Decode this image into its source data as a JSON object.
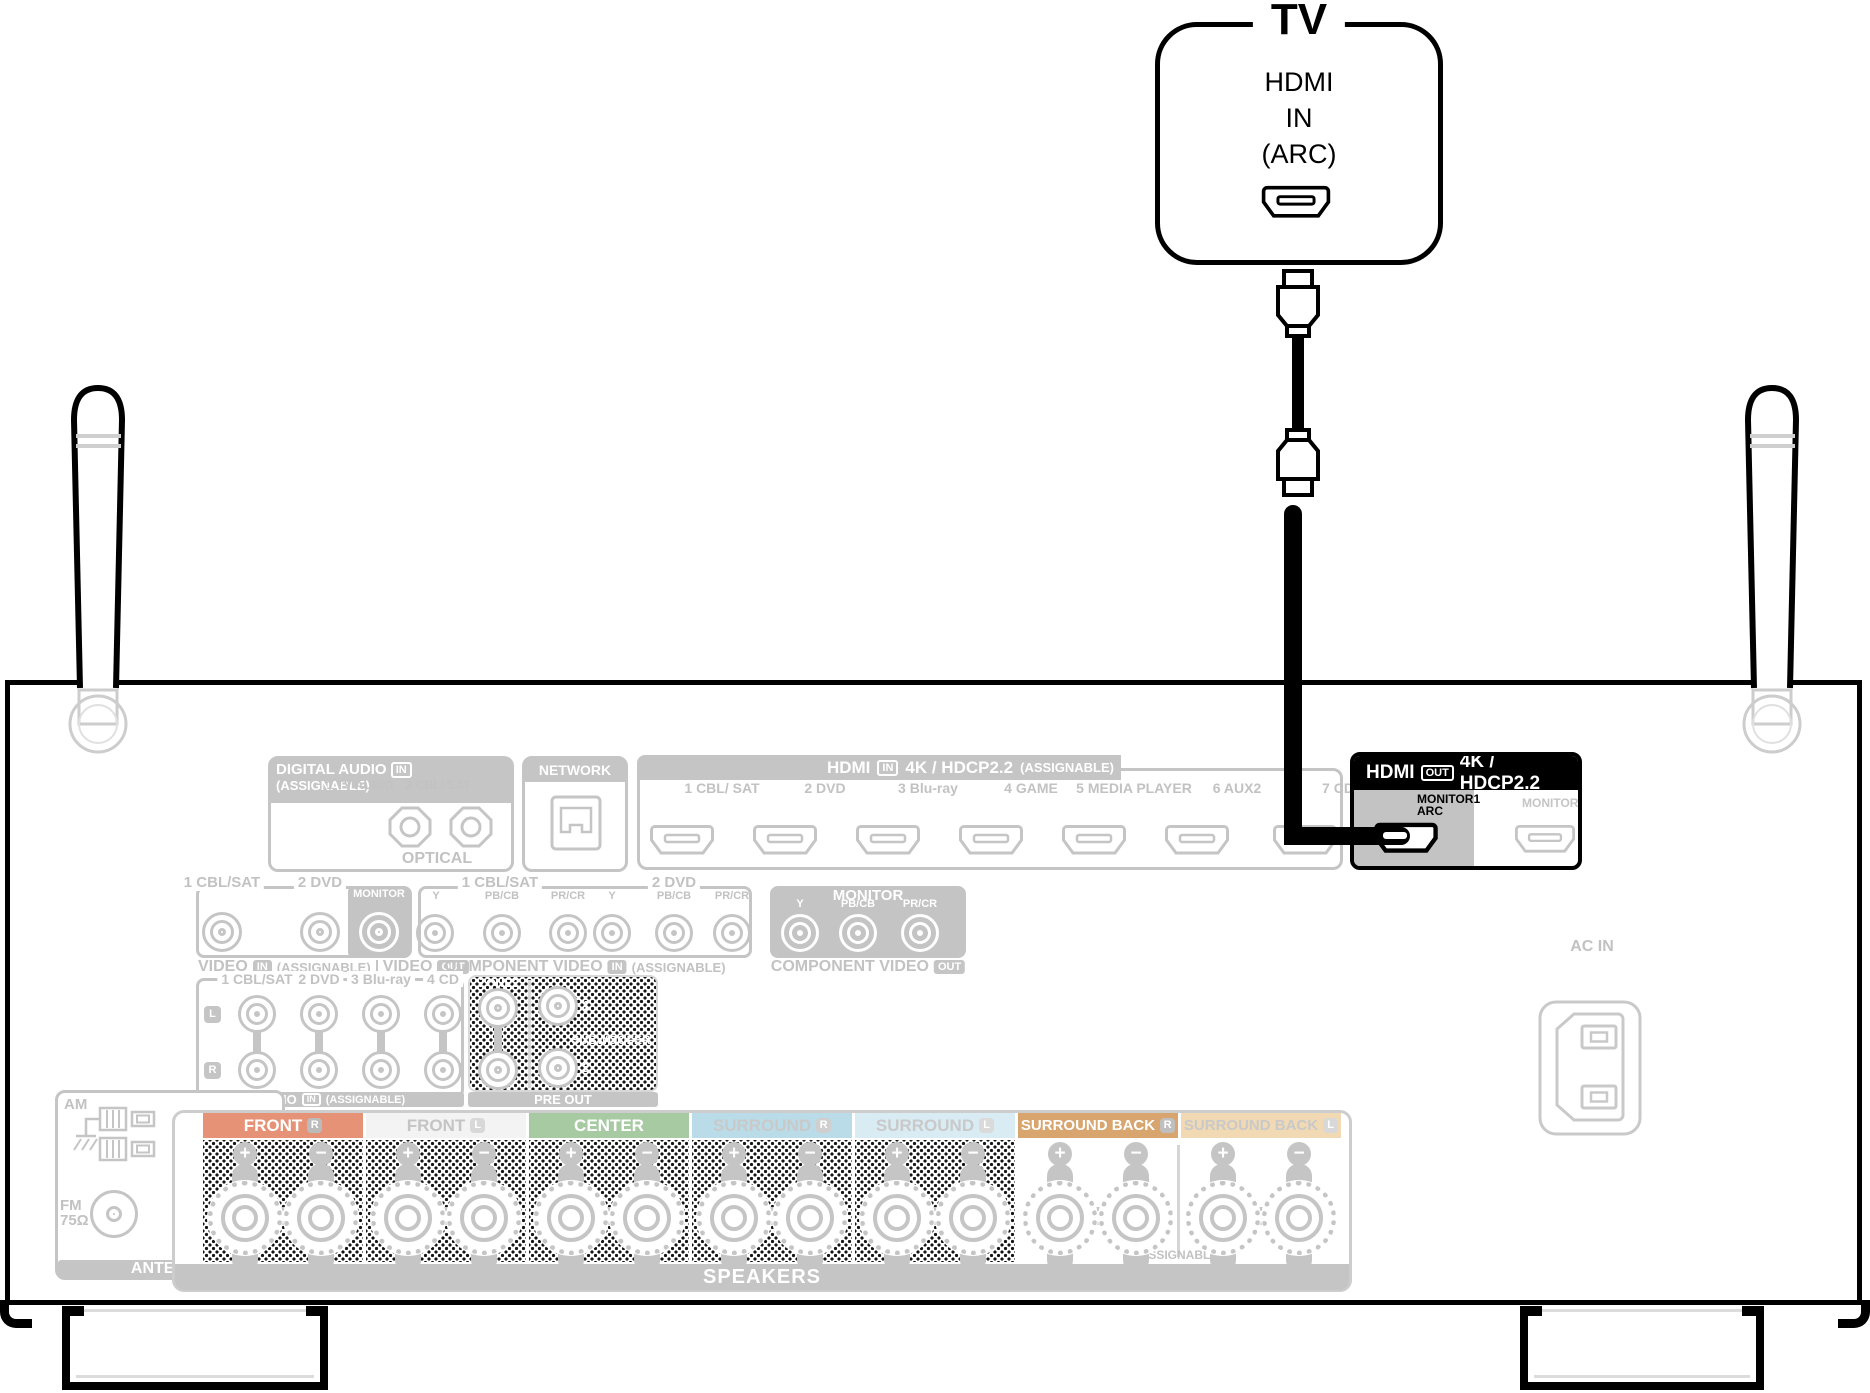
{
  "tv": {
    "label": "TV",
    "port_lines": "HDMI\nIN\n(ARC)"
  },
  "receiver": {
    "digital_audio": {
      "title": "DIGITAL AUDIO",
      "badge": "IN",
      "note": "(ASSIGNABLE)",
      "port1": "1\nTV\nAUDIO",
      "port2": "2\nCBL/\nSAT",
      "footer": "OPTICAL"
    },
    "network": {
      "title": "NETWORK"
    },
    "hdmi_in": {
      "title": "HDMI",
      "badge": "IN",
      "spec": "4K / HDCP2.2",
      "note": "(ASSIGNABLE)",
      "ports": [
        "1\nCBL/\nSAT",
        "2\nDVD",
        "3\nBlu-ray",
        "4\nGAME",
        "5\nMEDIA\nPLAYER",
        "6\nAUX2",
        "7\nCD"
      ]
    },
    "hdmi_out": {
      "title": "HDMI",
      "badge": "OUT",
      "spec": "4K / HDCP2.2",
      "monitor1": "MONITOR1\nARC",
      "monitor2": "MONITOR2"
    },
    "video": {
      "in1": "1 CBL/SAT",
      "in2": "2 DVD",
      "monitor": "MONITOR",
      "footer": {
        "t1": "VIDEO",
        "b1": "IN",
        "n1": "(ASSIGNABLE)",
        "t2": "VIDEO",
        "b2": "OUT"
      }
    },
    "component": {
      "g1": "1 CBL/SAT",
      "g2": "2 DVD",
      "monitor": "MONITOR",
      "cols": [
        "Y",
        "PB/CB",
        "PR/CR"
      ],
      "footer_in": {
        "t": "COMPONENT VIDEO",
        "b": "IN",
        "n": "(ASSIGNABLE)"
      },
      "footer_out": {
        "t": "COMPONENT VIDEO",
        "b": "OUT"
      }
    },
    "audio": {
      "cols": [
        "1 CBL/SAT",
        "2 DVD",
        "3 Blu-ray",
        "4 CD"
      ],
      "l": "L",
      "r": "R",
      "footer": {
        "t": "AUDIO",
        "b": "IN",
        "n": "(ASSIGNABLE)"
      }
    },
    "pre_out": {
      "zone2": "ZONE2",
      "subwoofer": "SUBWOOFER",
      "n1": "1",
      "n2": "2",
      "footer": "PRE OUT"
    },
    "antenna": {
      "am": "AM",
      "fm": "FM\n75Ω",
      "footer": "ANTENNA"
    },
    "ac_in": "AC IN",
    "speakers": {
      "plus": "+",
      "minus": "−",
      "assignable": "ASSIGNABLE",
      "footer": "SPEAKERS",
      "sections": [
        {
          "label": "FRONT",
          "tag": "R",
          "bar": "#e69277",
          "text": "#ffffff",
          "tag_bg": "#bbbbbb"
        },
        {
          "label": "FRONT",
          "tag": "L",
          "bar": "#f3f3f3",
          "text": "#c4c4c4",
          "tag_bg": "#d8d8d8"
        },
        {
          "label": "CENTER",
          "tag": "",
          "bar": "#a7caa2",
          "text": "#ffffff",
          "tag_bg": ""
        },
        {
          "label": "SURROUND",
          "tag": "R",
          "bar": "#badce9",
          "text": "#c9c9c9",
          "tag_bg": "#cfcfcf"
        },
        {
          "label": "SURROUND",
          "tag": "L",
          "bar": "#d9ecf4",
          "text": "#c9c9c9",
          "tag_bg": "#dadada"
        },
        {
          "label": "SURROUND BACK",
          "tag": "R",
          "bar": "#d8a56f",
          "text": "#ffffff",
          "tag_bg": "#bfbfbf"
        },
        {
          "label": "SURROUND BACK",
          "tag": "L",
          "bar": "#f1dab3",
          "text": "#c9c9c9",
          "tag_bg": "#d8d8d8"
        }
      ]
    }
  }
}
